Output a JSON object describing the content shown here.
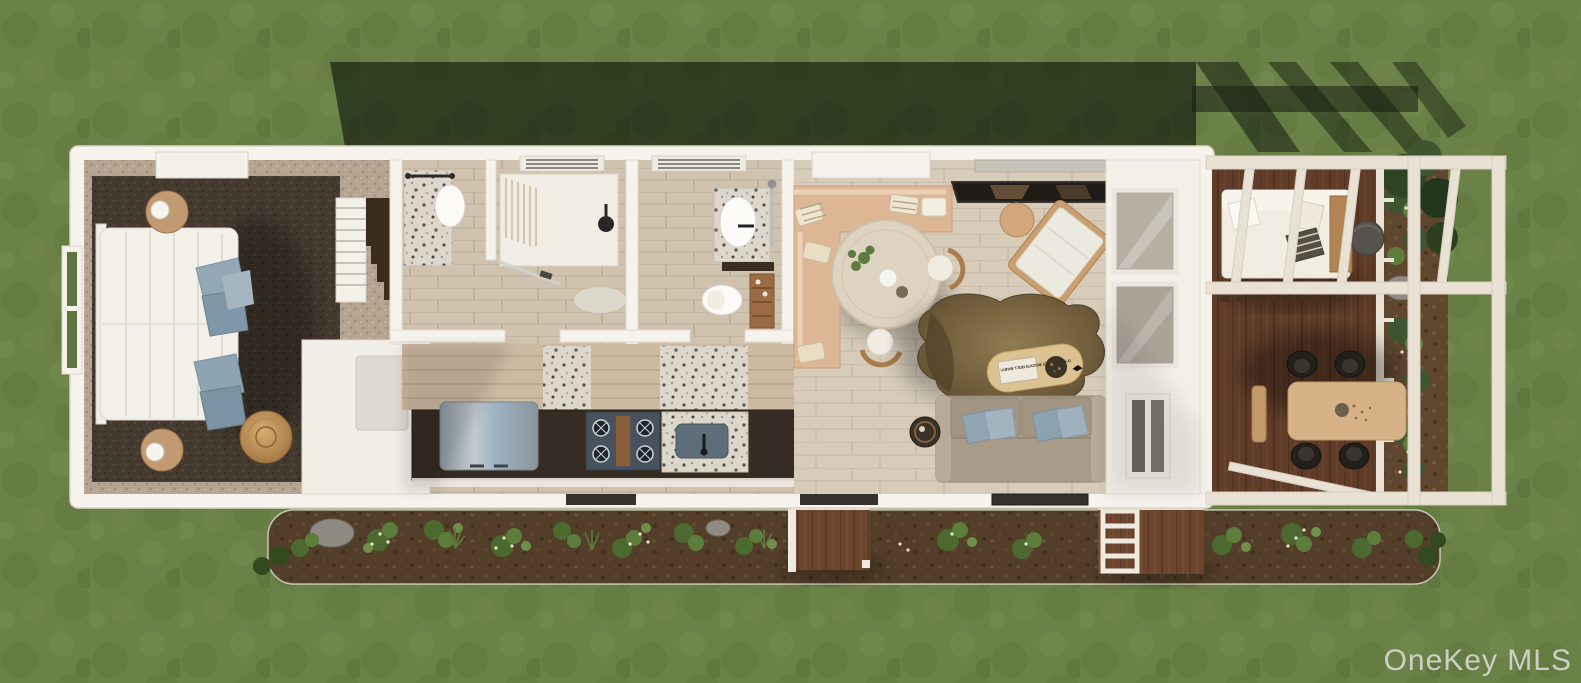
{
  "watermark": {
    "text": "OneKey MLS",
    "color": "#e3e3df"
  },
  "book": {
    "title": "IT'S NOT ONLY ROCK'N ROLL BABY!"
  },
  "palette": {
    "grass": "#7d9854",
    "grass_dark": "#6e8947",
    "grass_light": "#8aa45e",
    "shadow": "#161d10",
    "wall": "#f6f3ed",
    "wall_edge": "#dcd5c8",
    "floor_plank_light": "#d7ccba",
    "floor_plank_gray": "#cfc2af",
    "carpet_dark": "#4d4136",
    "carpet_light": "#b5a492",
    "deck_wood": "#6d452e",
    "mulch": "#5e462f",
    "terrazzo": "#ddd7cb",
    "cabinet_dark": "#362c23",
    "sofa": "#a99b8a",
    "pillow_blue": "#90a5b2",
    "duvet": "#f3f0e9",
    "banquette": "#ddb795",
    "wood_accent": "#c29a72",
    "pergola": "#e9e2d4",
    "outdoor_table": "#d6b286",
    "rug_fur_center": "#8f7b50",
    "rug_fur_edge": "#5c4b2d"
  },
  "regions": {
    "lawn": {
      "label": "Lawn"
    },
    "house_shadow": {
      "label": "Shadow cast by house and pergola"
    },
    "house": {
      "label": "Tiny home floor plan, top view"
    },
    "bedroom": {
      "label": "Bedroom with bed, nightstands and stairs"
    },
    "bathroom": {
      "label": "Bathroom with vanity and walk-in shower"
    },
    "wc": {
      "label": "Bathroom with sink and toilet"
    },
    "kitchen": {
      "label": "Kitchen with fridge, range and sink"
    },
    "dining": {
      "label": "Dining area with banquette and round table"
    },
    "living": {
      "label": "Living area with sofa, rug and lounge chair"
    },
    "closet": {
      "label": "Closet wall with glass wardrobes"
    },
    "deck": {
      "label": "Covered wood deck"
    },
    "pergola": {
      "label": "White pergola frame"
    },
    "garden_bottom": {
      "label": "Front garden bed with shrubs and flowers"
    },
    "garden_side": {
      "label": "Side garden bed along deck"
    },
    "stoop_left": {
      "label": "Entry steps with railing"
    },
    "stoop_right": {
      "label": "Entry steps with ladder stairs"
    }
  }
}
